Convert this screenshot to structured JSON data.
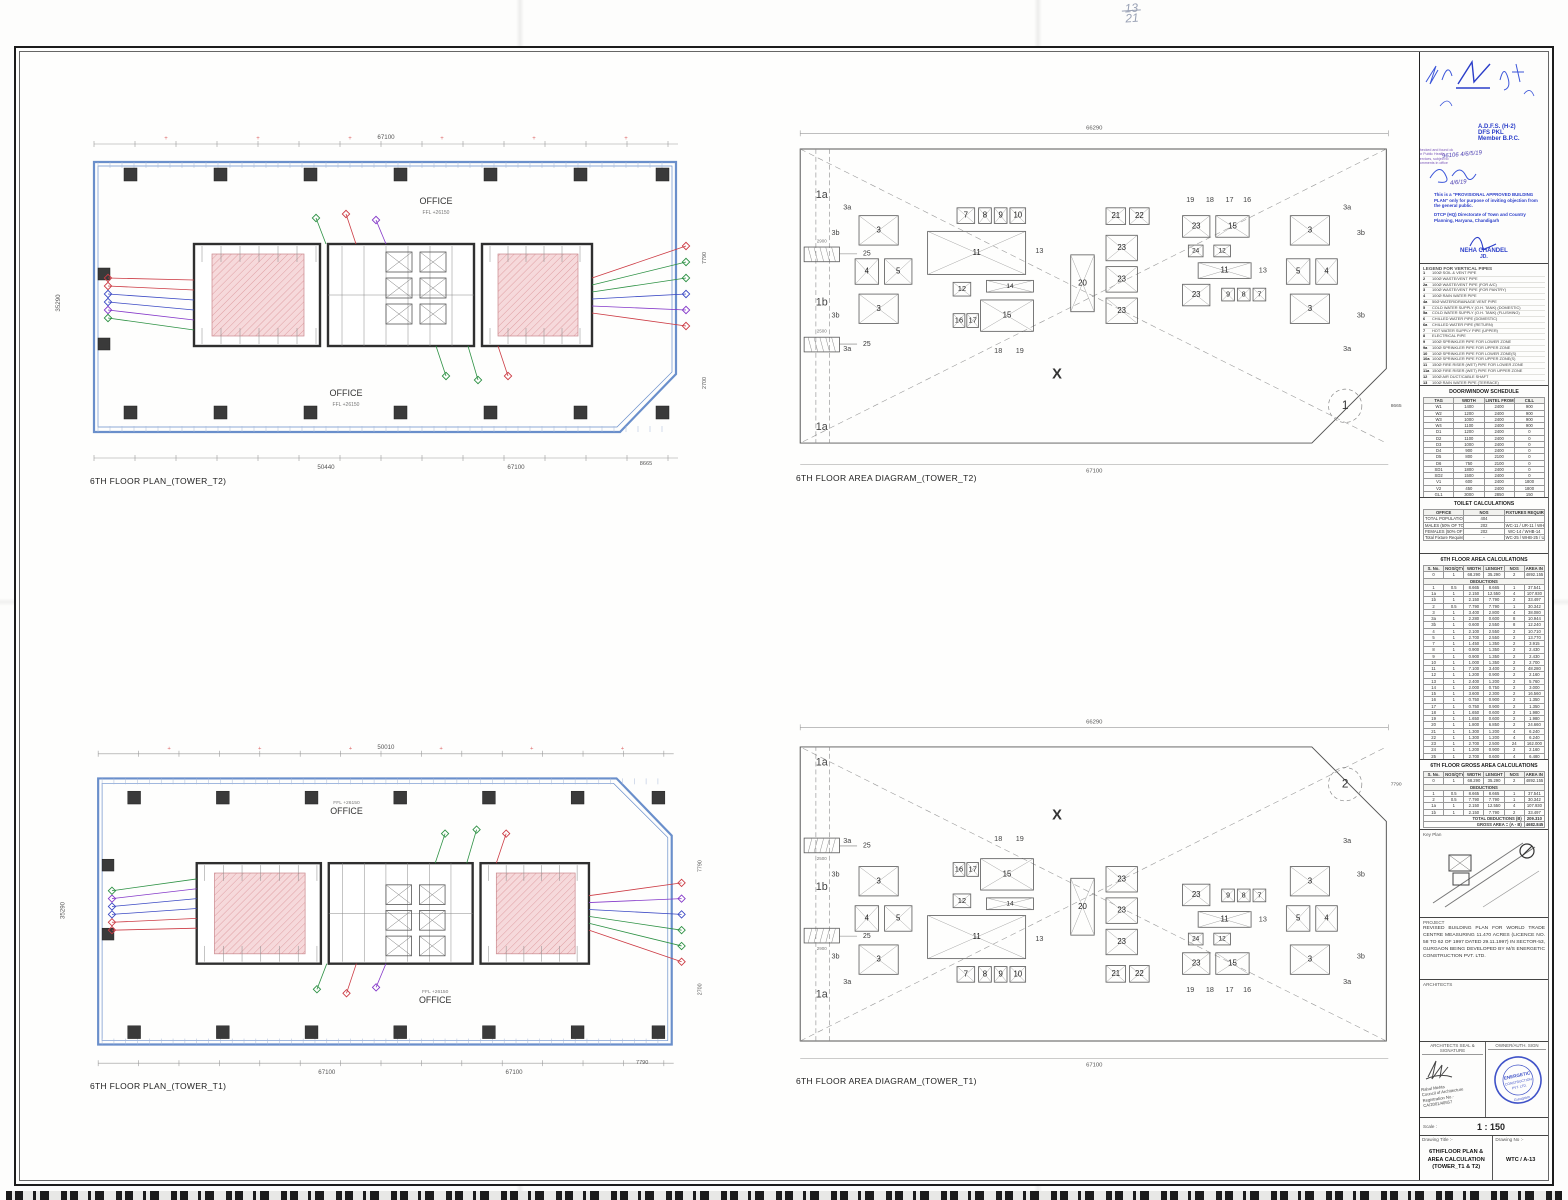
{
  "page": {
    "pencil_note_top": "13",
    "pencil_note_bottom": "21"
  },
  "drawings": {
    "plan_t2": {
      "title": "6TH FLOOR PLAN_(TOWER_T2)",
      "office": "OFFICE",
      "ffl": "FFL +26150",
      "dim_top": "67100",
      "dim_bottom": "50440",
      "dim_bottom2": "67100",
      "dim_chamfer": "8665",
      "dim_left": "35290",
      "dim_right": "7790",
      "dim_right2": "2700"
    },
    "plan_t1": {
      "title": "6TH FLOOR PLAN_(TOWER_T1)",
      "office": "OFFICE",
      "ffl": "FFL +26150",
      "dim_top": "50010",
      "dim_bottom": "67100",
      "dim_bottom2": "67100",
      "dim_chamfer": "7790",
      "dim_left": "35290",
      "dim_right": "7790",
      "dim_right2": "2700"
    },
    "area_t2": {
      "title": "6TH FLOOR AREA DIAGRAM_(TOWER_T2)",
      "dim_outer": "66290",
      "dim_inner": "67100",
      "dim_side": "8665",
      "detail": "1",
      "x_mark": "X",
      "edge_labels": [
        "1a",
        "1b",
        "1a"
      ],
      "shaft_label": "25",
      "dim_shaft_top": "2900",
      "dim_shaft_bot": "2500"
    },
    "area_t1": {
      "title": "6TH FLOOR AREA DIAGRAM_(TOWER_T1)",
      "dim_outer": "66290",
      "dim_inner": "67100",
      "dim_side": "7790",
      "detail": "2",
      "x_mark": "X",
      "edge_labels": [
        "1a",
        "1b",
        "1a"
      ],
      "shaft_label": "25",
      "dim_shaft_top": "2900",
      "dim_shaft_bot": "2500"
    },
    "area_boxes": [
      "3",
      "4",
      "5",
      "3",
      "7",
      "8",
      "9",
      "10",
      "11",
      "12",
      "14",
      "15",
      "16",
      "17",
      "20",
      "21",
      "22",
      "23",
      "23",
      "23",
      "23",
      "15",
      "24",
      "12",
      "11",
      "23",
      "9",
      "8",
      "7",
      "3",
      "5",
      "4",
      "3"
    ],
    "area_text_labels": [
      "3a",
      "3a",
      "3b",
      "3b",
      "13",
      "18",
      "19",
      "19",
      "18",
      "17",
      "16",
      "13",
      "3a",
      "3a",
      "3b",
      "3b"
    ]
  },
  "titleblock": {
    "stamps": {
      "adfs1": "A.D.F.S. (H-2)",
      "adfs2": "DFS PKL",
      "adfs3": "Member B.P.C.",
      "hand_nums": "96106   4/6/5/19",
      "hand_date": "4/6/19",
      "note": "This is a \"PROVISIONAL APPROVED BUILDING PLAN\" only for purpose of inviting objection from the general public.",
      "dept1": "DTCP (HQ)",
      "dept2": "Directorate of Town and Country Planning,",
      "dept3": "Haryana, Chandigarh",
      "officer": "NEHA CHANDEL",
      "officer_title": "JD.",
      "side_note": "checked and found ok for Public Health services, subject to comments in office"
    },
    "legend": {
      "title": "LEGEND FOR VERTICAL PIPES",
      "items": [
        [
          "1",
          "100Ø SOIL & VENT PIPE"
        ],
        [
          "2",
          "100Ø WASTE/VENT PIPE"
        ],
        [
          "2a",
          "100Ø WASTE/VENT PIPE (FOR A/C)"
        ],
        [
          "3",
          "100Ø WASTE/VENT PIPE (FOR PANTRY)"
        ],
        [
          "4",
          "100Ø RAIN WATER PIPE"
        ],
        [
          "4a",
          "50Ø WATER/DRAINAGE VENT PIPE"
        ],
        [
          "5",
          "COLD WATER SUPPLY (O.H. TANK) (DOMESTIC)"
        ],
        [
          "5a",
          "COLD WATER SUPPLY (O.H. TANK) (FLUSHING)"
        ],
        [
          "6",
          "CHILLED WATER PIPE (DOMESTIC)"
        ],
        [
          "6a",
          "CHILLED WATER PIPE (RETURN)"
        ],
        [
          "7",
          "HOT WATER SUPPLY PIPE (UPPER)"
        ],
        [
          "8",
          "ELECTRICAL PIPE"
        ],
        [
          "9",
          "100Ø SPRINKLER PIPE FOR LOWER ZONE"
        ],
        [
          "9a",
          "100Ø SPRINKLER PIPE FOR UPPER ZONE"
        ],
        [
          "10",
          "100Ø SPRINKLER PIPE FOR LOWER ZONE(S)"
        ],
        [
          "10a",
          "100Ø SPRINKLER PIPE FOR UPPER ZONE(S)"
        ],
        [
          "11",
          "150Ø FIRE RISER (WET) PIPE FOR LOWER ZONE"
        ],
        [
          "11a",
          "150Ø FIRE RISER (WET) PIPE FOR UPPER ZONE"
        ],
        [
          "12",
          "100Ø AIR DUCT/CABLE SHAFT"
        ],
        [
          "13",
          "100Ø RAIN WATER PIPE (TERRACE)"
        ],
        [
          "13a",
          "50Ø DRAIN PIPE FOR SHAFT"
        ],
        [
          "14",
          "FIRE HOSE CABINET"
        ],
        [
          "15",
          "FIRE DOOR/DAMPER"
        ],
        [
          "AD",
          "ACCESS DOOR"
        ]
      ]
    },
    "door_schedule": {
      "title": "DOOR/WINDOW SCHEDULE",
      "headers": [
        "TAG",
        "WIDTH",
        "LINTEL FROM FFL",
        "CILL"
      ],
      "rows": [
        [
          "W1",
          "1400",
          "2400",
          "900"
        ],
        [
          "W2",
          "1200",
          "2400",
          "900"
        ],
        [
          "W3",
          "1000",
          "2400",
          "900"
        ],
        [
          "W4",
          "1100",
          "2400",
          "900"
        ],
        [
          "D1",
          "1200",
          "2400",
          "0"
        ],
        [
          "D2",
          "1100",
          "2400",
          "0"
        ],
        [
          "D3",
          "1000",
          "2400",
          "0"
        ],
        [
          "D4",
          "900",
          "2400",
          "0"
        ],
        [
          "D5",
          "800",
          "2100",
          "0"
        ],
        [
          "D6",
          "750",
          "2100",
          "0"
        ],
        [
          "SD1",
          "1800",
          "2400",
          "0"
        ],
        [
          "SD2",
          "1500",
          "2400",
          "0"
        ],
        [
          "V1",
          "600",
          "2400",
          "1800"
        ],
        [
          "V2",
          "450",
          "2400",
          "1800"
        ],
        [
          "GL1",
          "3000",
          "2850",
          "150"
        ],
        [
          "GL2",
          "2400",
          "2850",
          "150"
        ]
      ]
    },
    "toilet": {
      "title": "TOILET CALCULATIONS",
      "headers": [
        "OFFICE",
        "NOS",
        "FIXTURES REQUIRED"
      ],
      "rows": [
        [
          "TOTAL POPULATION @ 10 Sqm/Person",
          "404",
          ""
        ],
        [
          "MALES (50% OF TOTAL POPULATION)",
          "202",
          "WC-11 / UR-11 / WHB-11"
        ],
        [
          "FEMALES (50% OF TOTAL POPULATION)",
          "202",
          "WC-14 / WHB-14"
        ],
        [
          "Total Fixture Requirement (Male & Female)",
          "-",
          "WC-25 / WHB-25 / UR-11"
        ]
      ]
    },
    "area_calc": {
      "title": "6TH FLOOR AREA CALCULATIONS",
      "headers": [
        "S. No.",
        "NOS/QTY",
        "WIDTH",
        "LENGHT",
        "NOS",
        "AREA IN SQMT"
      ],
      "rows": [
        [
          "0",
          "1",
          "68.290",
          "35.290",
          "2",
          "4892.155"
        ],
        "DEDUCTIONS",
        [
          "1",
          "0.5",
          "8.665",
          "8.665",
          "1",
          "37.541"
        ],
        [
          "1a",
          "1",
          "2.150",
          "12.550",
          "4",
          "107.930"
        ],
        [
          "1b",
          "1",
          "2.150",
          "7.790",
          "2",
          "33.497"
        ],
        [
          "2",
          "0.5",
          "7.790",
          "7.790",
          "1",
          "30.342"
        ],
        [
          "3",
          "1",
          "3.400",
          "2.800",
          "4",
          "38.080"
        ],
        [
          "3a",
          "1",
          "2.280",
          "0.600",
          "8",
          "10.944"
        ],
        [
          "3b",
          "1",
          "0.600",
          "2.550",
          "8",
          "12.240"
        ],
        [
          "4",
          "1",
          "2.100",
          "2.550",
          "2",
          "10.710"
        ],
        [
          "5",
          "1",
          "2.700",
          "2.550",
          "2",
          "13.770"
        ],
        [
          "7",
          "1",
          "1.450",
          "1.350",
          "2",
          "3.915"
        ],
        [
          "8",
          "1",
          "0.900",
          "1.350",
          "2",
          "2.430"
        ],
        [
          "9",
          "1",
          "0.900",
          "1.350",
          "2",
          "2.430"
        ],
        [
          "10",
          "1",
          "1.000",
          "1.350",
          "2",
          "2.700"
        ],
        [
          "11",
          "1",
          "7.100",
          "3.400",
          "2",
          "48.280"
        ],
        [
          "12",
          "1",
          "1.200",
          "0.900",
          "2",
          "2.160"
        ],
        [
          "13",
          "1",
          "2.400",
          "1.200",
          "2",
          "5.760"
        ],
        [
          "14",
          "1",
          "2.000",
          "0.750",
          "2",
          "3.000"
        ],
        [
          "15",
          "1",
          "3.600",
          "2.300",
          "2",
          "16.560"
        ],
        [
          "16",
          "1",
          "0.750",
          "0.900",
          "2",
          "1.350"
        ],
        [
          "17",
          "1",
          "0.750",
          "0.900",
          "2",
          "1.350"
        ],
        [
          "18",
          "1",
          "1.650",
          "0.600",
          "2",
          "1.980"
        ],
        [
          "19",
          "1",
          "1.650",
          "0.600",
          "2",
          "1.980"
        ],
        [
          "20",
          "1",
          "1.800",
          "6.850",
          "2",
          "24.660"
        ],
        [
          "21",
          "1",
          "1.300",
          "1.200",
          "4",
          "6.240"
        ],
        [
          "22",
          "1",
          "1.300",
          "1.200",
          "4",
          "6.240"
        ],
        [
          "23",
          "1",
          "2.700",
          "2.500",
          "24",
          "162.000"
        ],
        [
          "24",
          "1",
          "1.200",
          "0.900",
          "2",
          "2.160"
        ],
        [
          "25",
          "1",
          "2.700",
          "0.600",
          "4",
          "6.480"
        ],
        [
          "26",
          "1",
          "1.500",
          "0.900",
          "2",
          "2.700"
        ],
        [
          "TOTAL DEDUCTIONS (B)",
          "726.711"
        ],
        [
          "COVERED AREA = (A - B)",
          "4165.444"
        ]
      ]
    },
    "gross_calc": {
      "title": "6TH FLOOR GROSS AREA CALCULATIONS",
      "headers": [
        "S. No.",
        "NOS/QTY",
        "WIDTH",
        "LENGHT",
        "NOS",
        "AREA IN SQMT"
      ],
      "rows": [
        [
          "0",
          "1",
          "68.290",
          "35.290",
          "2",
          "4892.155"
        ],
        "DEDUCTIONS",
        [
          "1",
          "0.5",
          "8.665",
          "8.665",
          "1",
          "37.541"
        ],
        [
          "2",
          "0.5",
          "7.790",
          "7.790",
          "1",
          "30.342"
        ],
        [
          "1a",
          "1",
          "2.150",
          "12.550",
          "4",
          "107.930"
        ],
        [
          "1b",
          "1",
          "2.150",
          "7.790",
          "2",
          "33.497"
        ],
        [
          "TOTAL DEDUCTIONS (B)",
          "209.310"
        ],
        [
          "GROSS AREA = (A - B)",
          "4682.845"
        ]
      ]
    },
    "key_plan_label": "Key Plan",
    "project": {
      "label": "PROJECT",
      "text": "REVISED BUILDING PLAN FOR WORLD TRADE CENTRE MEASURING 11.470 ACRES (LICENCE NO. 58 TO 62 OF 1997 DATED 29.11.1997) IN SECTOR-53, GURGAON BEING DEVELOPED BY M/S ENERGETIC CONSTRUCTION PVT. LTD."
    },
    "architects_label": "ARCHITECTS",
    "seal": {
      "left_label": "ARCHITECTS  SEAL & SIGNATURE",
      "right_label": "OWNER/AUTH. SIGN",
      "architect_name": "Rahul Mehta",
      "coa": "Council of Architecture",
      "reg": "Registration No.- CA/2001/40557",
      "stamp_line1": "ENERGETIC",
      "stamp_line2": "CONSTRUCTION PVT. LTD.",
      "stamp_line3": "Gurugram"
    },
    "scale": {
      "label": "Scale :",
      "value": "1 : 150"
    },
    "title_row": {
      "label": "Drawing Title :-",
      "value": "6TH/FLOOR PLAN & AREA CALCULATION (TOWER_T1 & T2)",
      "no_label": "Drawing No :-",
      "no_value": "WTC / A-13"
    }
  },
  "colors": {
    "perimeter_blue": "#6a8fcb",
    "core_pink": "#f6d9db",
    "hatch_red": "#d98f94",
    "column_dark": "#3a3a3a",
    "stamp_blue": "#2b3ec9",
    "leader_red": "#cc3b44",
    "leader_green": "#2d9144",
    "leader_blue": "#3b49c4",
    "leader_purple": "#8438c9"
  }
}
